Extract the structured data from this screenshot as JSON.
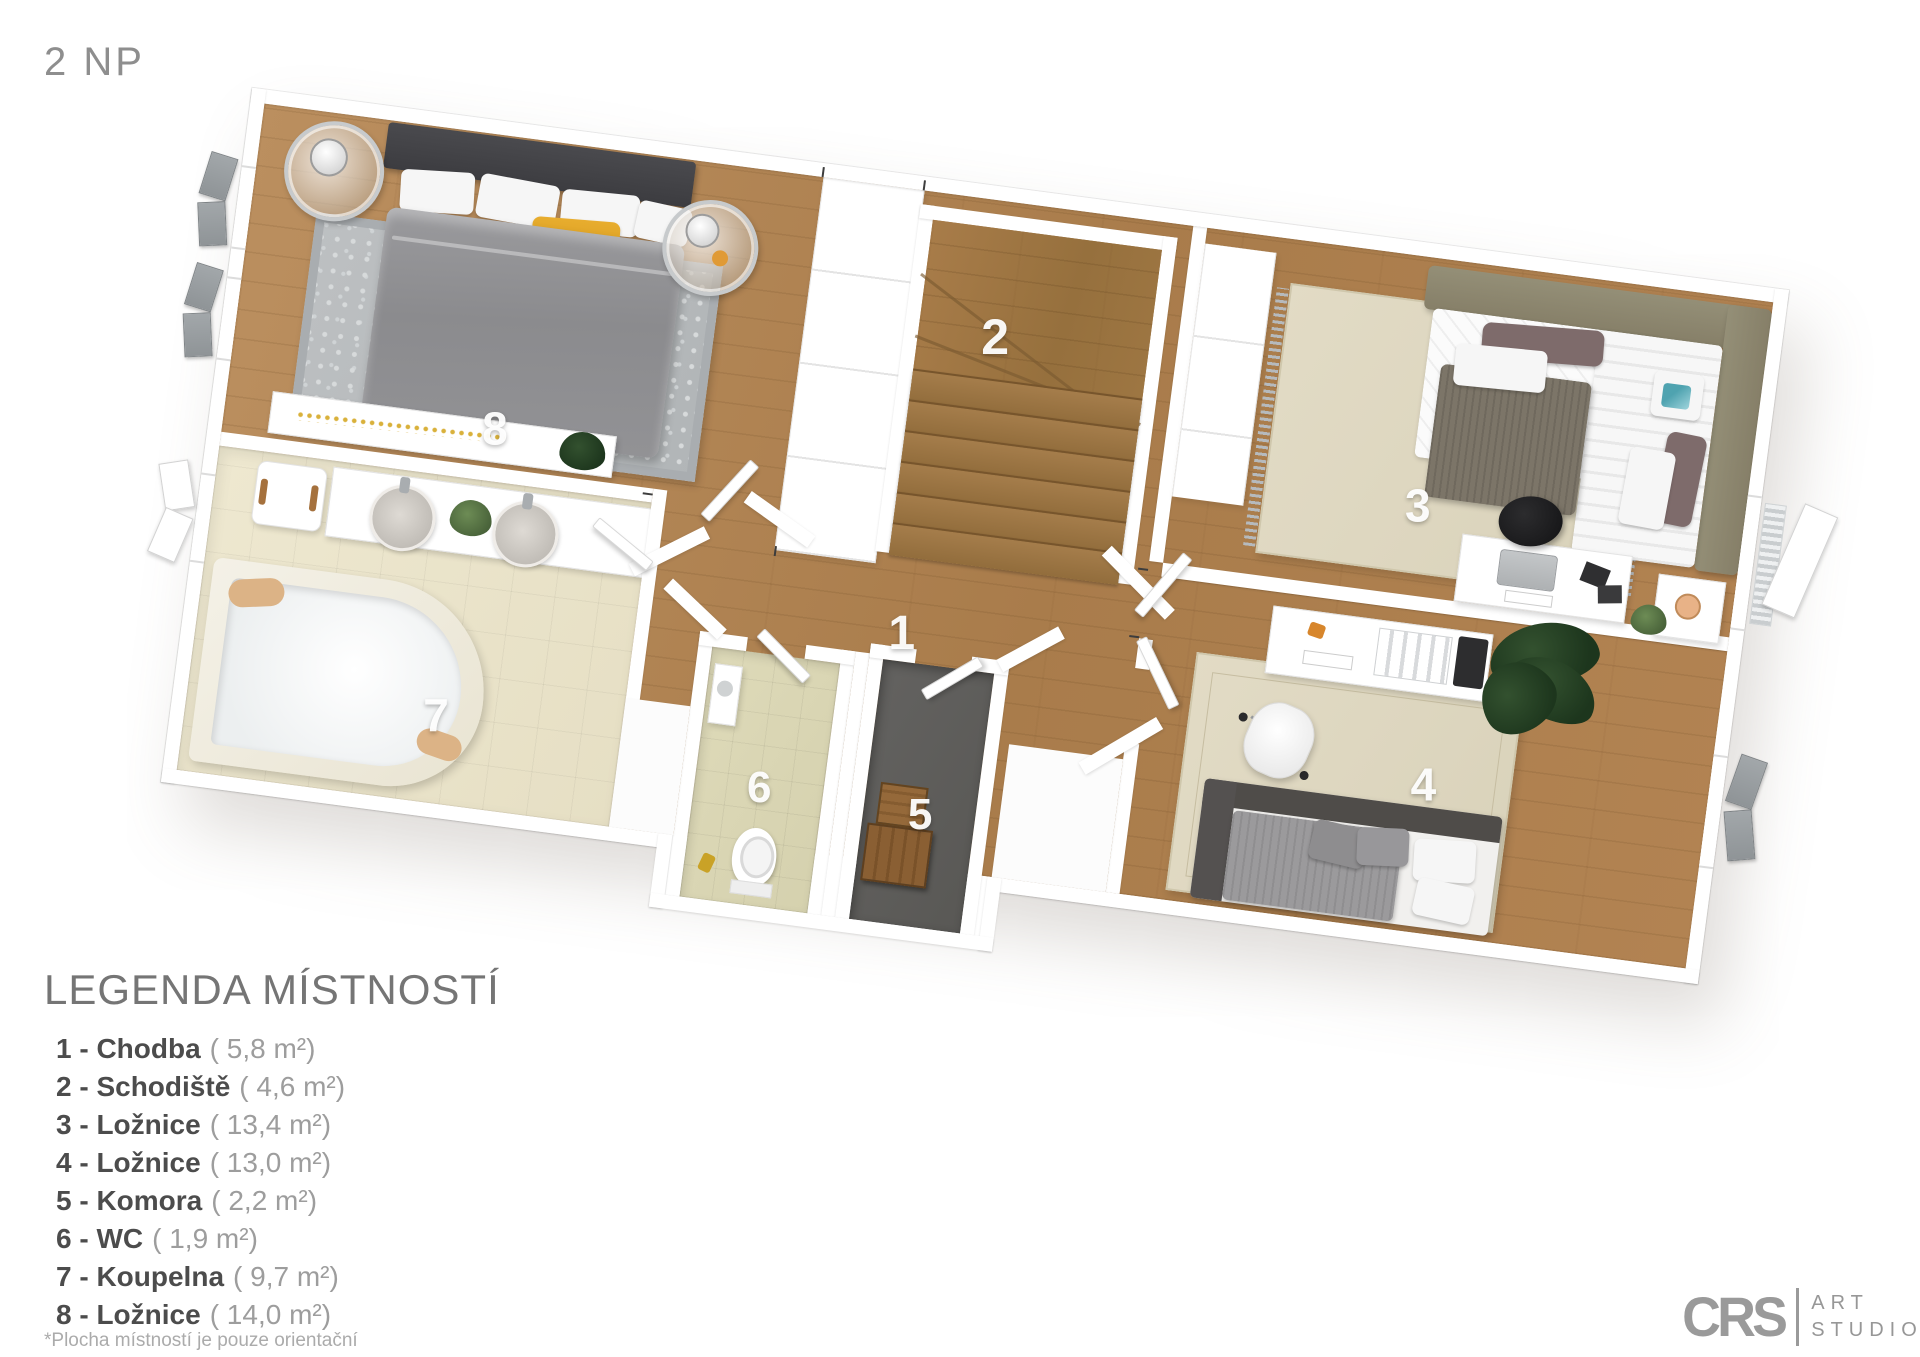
{
  "floor_label": "2 NP",
  "legend": {
    "title": "LEGENDA MÍSTNOSTÍ",
    "items": [
      {
        "label": "1 - Chodba",
        "area": "( 5,8 m²)"
      },
      {
        "label": "2 - Schodiště",
        "area": "( 4,6 m²)"
      },
      {
        "label": "3 - Ložnice",
        "area": "( 13,4 m²)"
      },
      {
        "label": "4 - Ložnice",
        "area": "( 13,0 m²)"
      },
      {
        "label": "5 - Komora",
        "area": "( 2,2 m²)"
      },
      {
        "label": "6 - WC",
        "area": "( 1,9 m²)"
      },
      {
        "label": "7 - Koupelna",
        "area": "( 9,7 m²)"
      },
      {
        "label": "8 - Ložnice",
        "area": "( 14,0 m²)"
      }
    ],
    "footnote": "*Plocha místností je pouze orientační"
  },
  "plan": {
    "rooms": [
      {
        "number": "1",
        "name": "Chodba"
      },
      {
        "number": "2",
        "name": "Schodiště"
      },
      {
        "number": "3",
        "name": "Ložnice"
      },
      {
        "number": "4",
        "name": "Ložnice"
      },
      {
        "number": "5",
        "name": "Komora"
      },
      {
        "number": "6",
        "name": "WC"
      },
      {
        "number": "7",
        "name": "Koupelna"
      },
      {
        "number": "8",
        "name": "Ložnice"
      }
    ]
  },
  "logo": {
    "abbr": "CRS",
    "name_line1": "ART",
    "name_line2": "STUDIO"
  }
}
